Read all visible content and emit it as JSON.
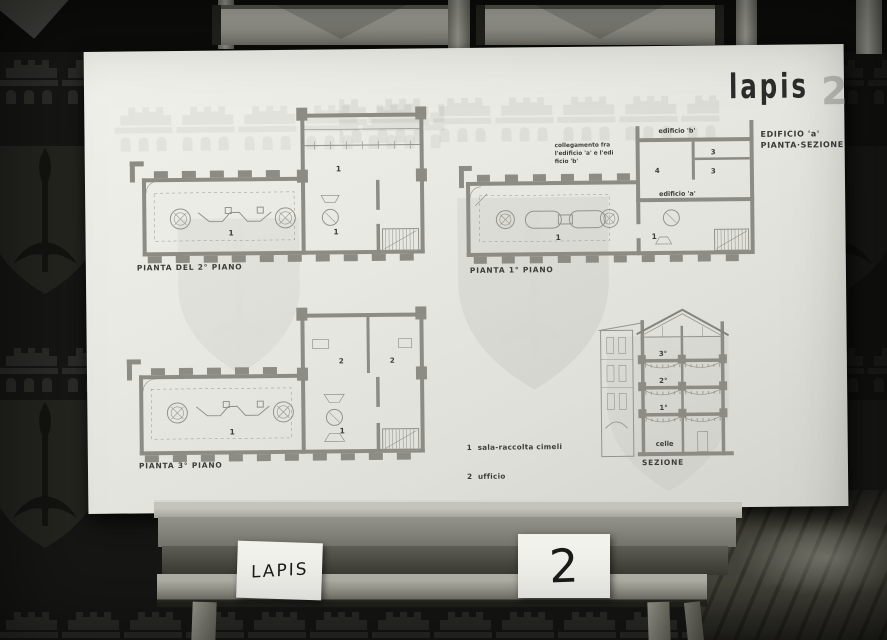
{
  "board": {
    "title": "lapis",
    "board_number": "2",
    "subtitle": {
      "line1": "EDIFICIO 'a'",
      "line2": "PIANTA·SEZIONE"
    },
    "plan_second_floor": {
      "caption": "PIANTA DEL 2° PIANO",
      "rooms": {
        "wing": "1",
        "hall": "1",
        "right": "1"
      }
    },
    "plan_first_floor": {
      "caption": "PIANTA 1° PIANO",
      "annotation_line1": "collegamento fra",
      "annotation_line2": "l'edificio 'a' e l'edi",
      "annotation_line3": "ficio 'b'",
      "building_b_label": "edificio 'b'",
      "building_a_label": "edificio 'a'",
      "rooms": {
        "corridor": "4",
        "toilet_upper": "3",
        "toilet_lower": "3",
        "hall": "1",
        "right": "1"
      }
    },
    "plan_third_floor": {
      "caption": "PIANTA 3° PIANO",
      "rooms": {
        "wing_left": "2",
        "wing_right": "2",
        "hall": "1",
        "right": "1"
      }
    },
    "section": {
      "caption": "SEZIONE",
      "floor3": "3°",
      "floor2": "2°",
      "floor1": "1°",
      "basement": "celle"
    },
    "legend": {
      "item1": "1  sala-raccolta cimeli",
      "item2": "2  ufficio",
      "item3": "3  toilette",
      "item4": "4  corridoio"
    }
  },
  "cards": {
    "name_card": "LAPIS",
    "number_card": "2"
  }
}
